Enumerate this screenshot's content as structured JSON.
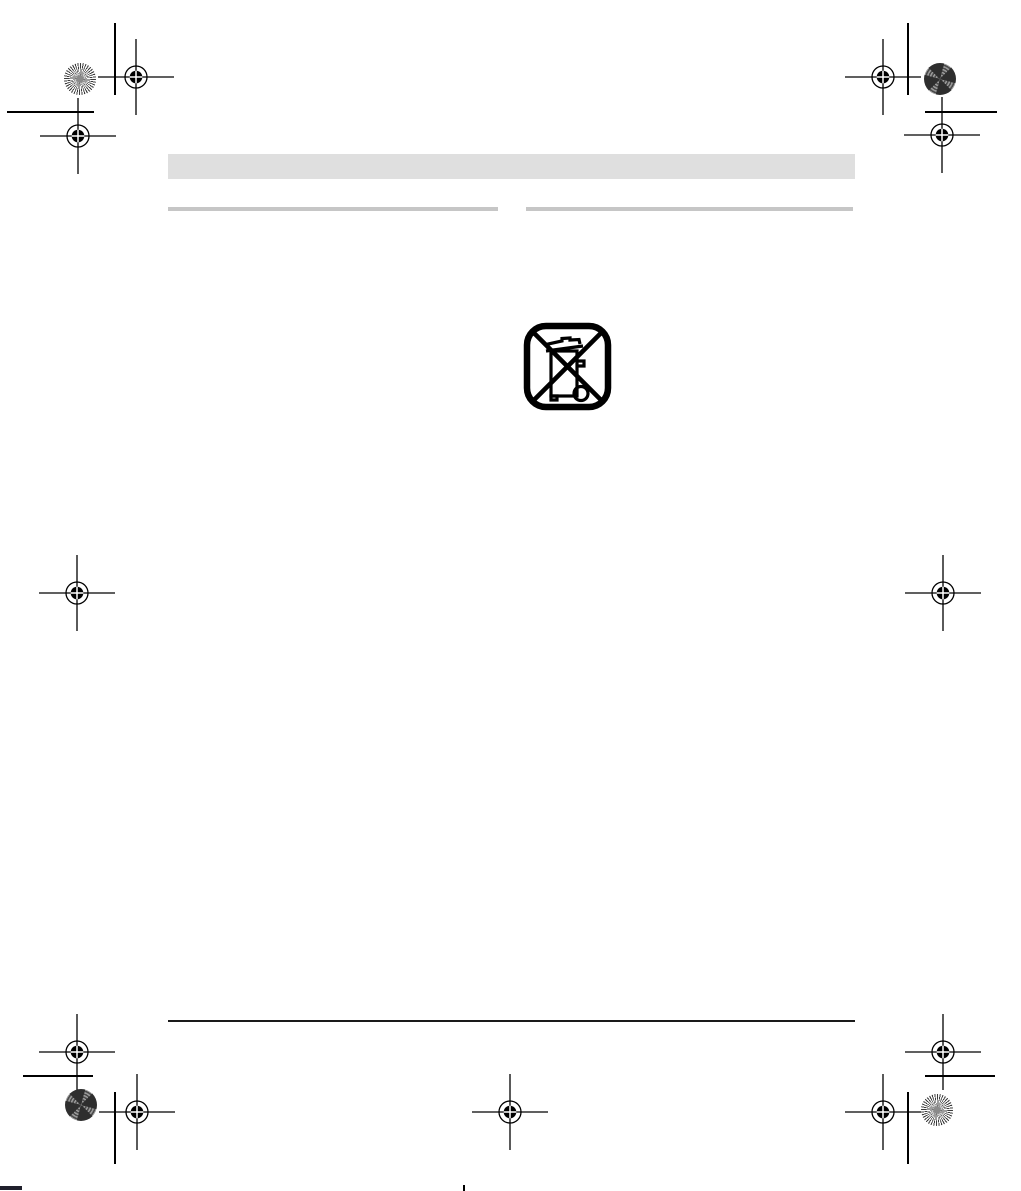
{
  "colors": {
    "paper": "#ffffff",
    "header_bar": "#dfdfdf",
    "column_rule": "#c6c6c6",
    "footer_rule": "#1a1a1a",
    "mark": "#000000"
  },
  "icons": {
    "weee": "crossed-out-wheelie-bin-icon",
    "registration_mark": "crosshair-circle-registration-mark",
    "star_target_sunburst": "radial-sunburst-calibration-star",
    "star_target_cross": "concentric-cross-calibration-patch"
  },
  "content": {
    "header_bar_text": "",
    "left_column_heading_text": "",
    "right_column_heading_text": ""
  }
}
